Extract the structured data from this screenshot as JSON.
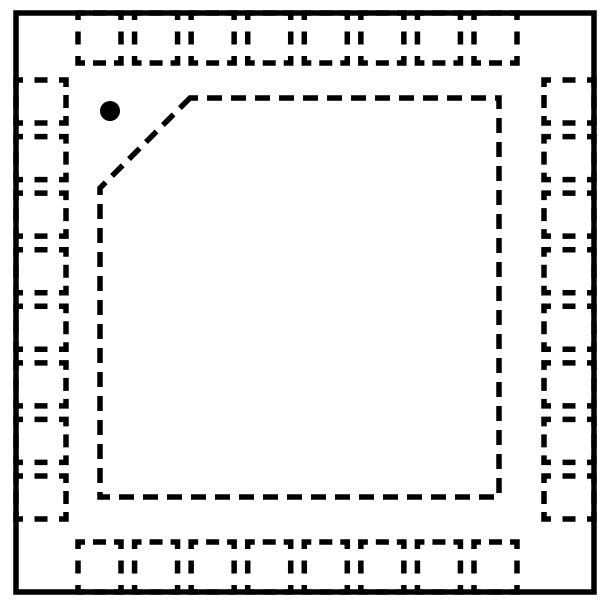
{
  "diagram": {
    "type": "qfn-package-outline-top-view",
    "description": "IC package outline drawing, quad flat no-lead style, top view with hidden (dashed) bottom pads",
    "pads_per_side": 8,
    "total_pads": 32,
    "colors": {
      "line": "#000000",
      "background": "#ffffff",
      "pin1_dot": "#000000"
    },
    "geometry": {
      "canvas": {
        "width": 600,
        "height": 600
      },
      "body": {
        "x": 16,
        "y": 13,
        "width": 578,
        "height": 579,
        "stroke_width": 5.5
      },
      "pads": {
        "width": 43,
        "depth": 50,
        "stroke_width": 5.5,
        "corner_dash": 14,
        "mid_dash": 13,
        "top_bottom_span": {
          "first": 78,
          "last_end": 517
        },
        "left_right_span": {
          "first": 80,
          "last_end": 519
        }
      },
      "exposed_pad": {
        "left": 100,
        "top": 98,
        "right": 499,
        "bottom": 497,
        "chamfer": 90,
        "stroke_width": 5.5,
        "dash": "15 9",
        "dash_offset": 7
      },
      "pin1_dot": {
        "cx": 110,
        "cy": 111,
        "r": 10
      }
    }
  }
}
